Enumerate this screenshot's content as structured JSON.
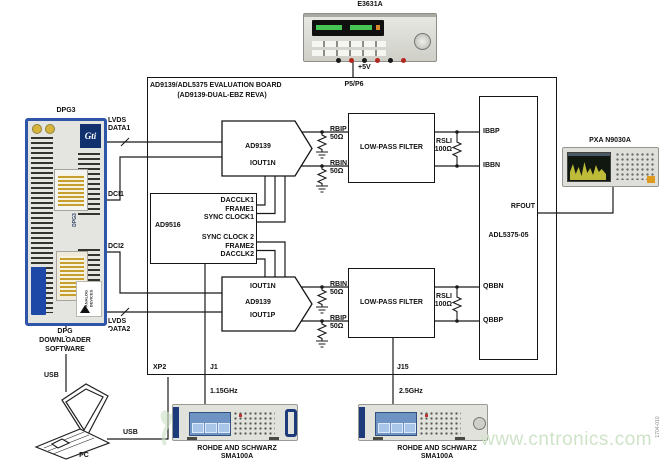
{
  "figure_code": "1704-010",
  "watermark": {
    "text": "www.cntronics.com",
    "color": "#cfe3c8"
  },
  "colors": {
    "wire": "#1a1a1a",
    "dpg_frame_blue": "#2f55a8",
    "instrument_navy": "#1d3a7a",
    "gold_connector": "#c79f2e"
  },
  "power_supply": {
    "model": "E3631A",
    "voltage": "+5V",
    "connector": "P5/P6"
  },
  "dpg": {
    "title": "DPG3",
    "logo": "Gti",
    "marking": "DPG3",
    "adi": "ANALOG DEVICES",
    "software": [
      "DPG",
      "DOWNLOADER",
      "SOFTWARE"
    ],
    "lvds_data1": [
      "LVDS",
      "DATA1"
    ],
    "dci1": "DCI1",
    "dci2": "DCI2",
    "lvds_data2": [
      "LVDS",
      "DATA2"
    ],
    "usb_top": "USB",
    "usb_bottom": "USB"
  },
  "pc": "PC",
  "board": {
    "title": [
      "AD9139/ADL5375 EVALUATION BOARD",
      "(AD9139-DUAL-EBZ REVA)"
    ],
    "xp2": "XP2",
    "j1": "J1",
    "j15": "J15",
    "dac_top": {
      "name": "AD9139",
      "out": "IOUT1N"
    },
    "dac_bottom": {
      "name": "AD9139",
      "out_n": "IOUT1N",
      "out_p": "IOUT1P"
    },
    "clock": {
      "name": "AD9516",
      "pins": [
        "DACCLK1",
        "FRAME1",
        "SYNC CLOCK1",
        "SYNC CLOCK 2",
        "FRAME2",
        "DACCLK2"
      ]
    },
    "filter": "LOW-PASS FILTER",
    "adl": {
      "name": "ADL5375-05",
      "ibbp": "IBBP",
      "ibbn": "IBBN",
      "qbbn": "QBBN",
      "qbbp": "QBBP",
      "rfout": "RFOUT"
    },
    "res": {
      "rbip": {
        "n": "RBIP",
        "v": "50Ω"
      },
      "rbin": {
        "n": "RBIN",
        "v": "50Ω"
      },
      "rsli": {
        "n": "RSLI",
        "v": "100Ω"
      }
    }
  },
  "analyzer": {
    "model": "PXA N9030A"
  },
  "generators": [
    {
      "freq": "1.15GHz",
      "brand": "ROHDE AND SCHWARZ",
      "model": "SMA100A"
    },
    {
      "freq": "2.5GHz",
      "brand": "ROHDE AND SCHWARZ",
      "model": "SMA100A"
    }
  ]
}
